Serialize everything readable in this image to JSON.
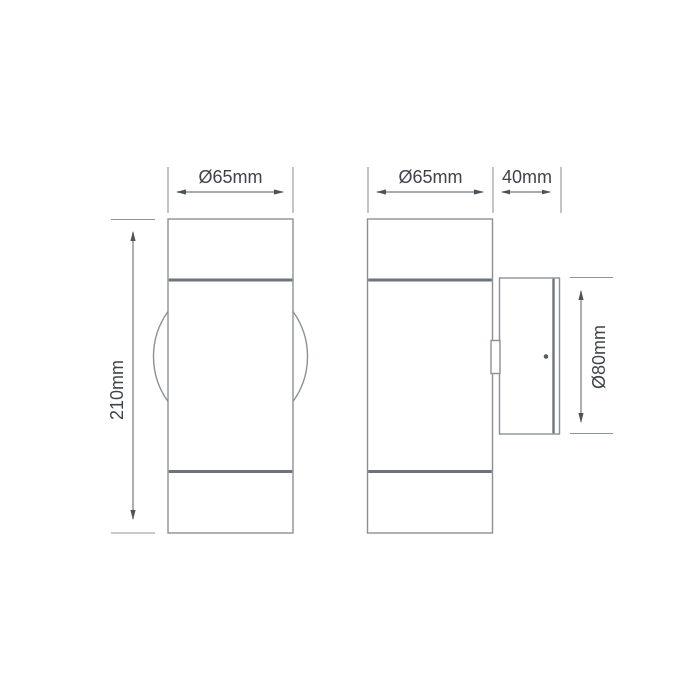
{
  "drawing": {
    "front_view": {
      "diameter_label": "Ø65mm",
      "height_label": "210mm"
    },
    "side_view": {
      "diameter_label": "Ø65mm",
      "bracket_depth_label": "40mm",
      "backplate_diameter_label": "Ø80mm"
    }
  },
  "colors": {
    "outline": "#8b9096",
    "thick": "#6e737b",
    "dim": "#75797f",
    "ext": "#8f949a",
    "arrow": "#4e5358",
    "text": "#3f444a",
    "bg": "#ffffff"
  }
}
